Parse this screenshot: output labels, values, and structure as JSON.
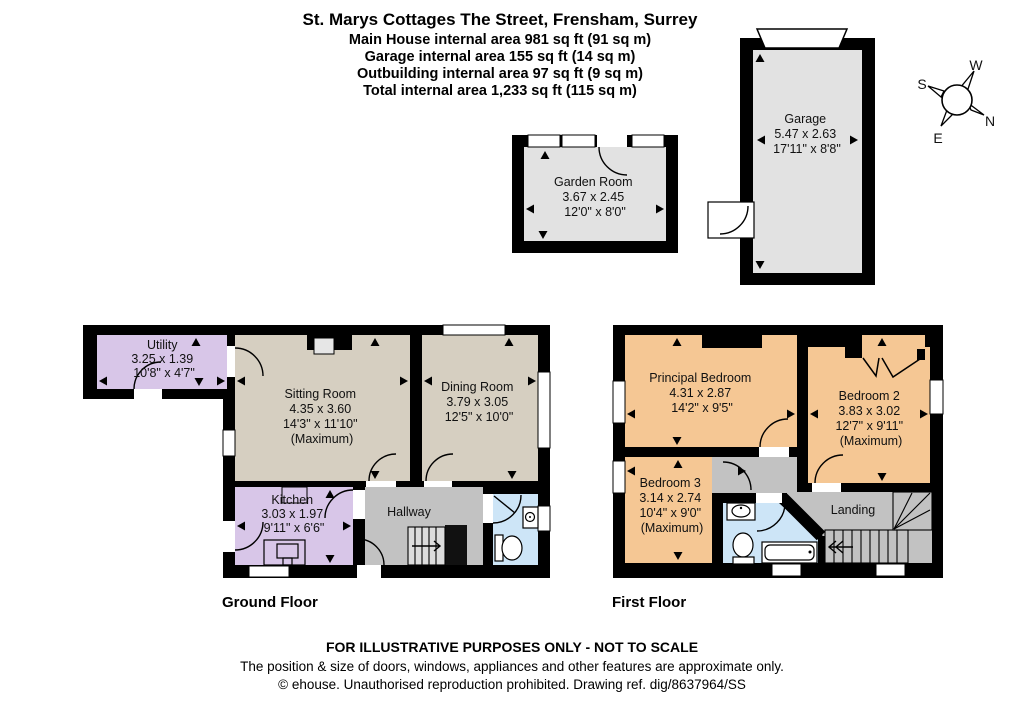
{
  "header": {
    "address": "St. Marys Cottages The Street, Frensham, Surrey",
    "area_lines": [
      "Main House internal area 981 sq ft (91 sq m)",
      "Garage internal area 155 sq ft (14 sq m)",
      "Outbuilding internal area 97 sq ft (9 sq m)",
      "Total internal area 1,233 sq ft (115 sq m)"
    ]
  },
  "compass": {
    "north": "N",
    "east": "E",
    "south": "S",
    "west": "W"
  },
  "rooms": {
    "garden_room": {
      "name": "Garden Room",
      "metric": "3.67 x 2.45",
      "imperial": "12'0\" x 8'0\""
    },
    "garage": {
      "name": "Garage",
      "metric": "5.47 x 2.63",
      "imperial": "17'11\" x 8'8\""
    },
    "utility": {
      "name": "Utility",
      "metric": "3.25 x 1.39",
      "imperial": "10'8\" x 4'7\""
    },
    "sitting_room": {
      "name": "Sitting Room",
      "metric": "4.35 x 3.60",
      "imperial": "14'3\" x 11'10\"",
      "qualifier": "(Maximum)"
    },
    "dining_room": {
      "name": "Dining Room",
      "metric": "3.79 x 3.05",
      "imperial": "12'5\" x 10'0\""
    },
    "kitchen": {
      "name": "Kitchen",
      "metric": "3.03 x 1.97",
      "imperial": "9'11\" x 6'6\""
    },
    "hallway": {
      "name": "Hallway"
    },
    "principal_bedroom": {
      "name": "Principal Bedroom",
      "metric": "4.31 x 2.87",
      "imperial": "14'2\" x 9'5\""
    },
    "bedroom_2": {
      "name": "Bedroom 2",
      "metric": "3.83 x 3.02",
      "imperial": "12'7\" x 9'11\"",
      "qualifier": "(Maximum)"
    },
    "bedroom_3": {
      "name": "Bedroom 3",
      "metric": "3.14 x 2.74",
      "imperial": "10'4\" x 9'0\"",
      "qualifier": "(Maximum)"
    },
    "landing": {
      "name": "Landing"
    }
  },
  "floor_labels": {
    "ground": "Ground Floor",
    "first": "First Floor"
  },
  "footer": {
    "line1": "FOR ILLUSTRATIVE PURPOSES ONLY - NOT TO SCALE",
    "line2": "The position & size of doors, windows, appliances and other features are approximate only.",
    "line3": "© ehouse. Unauthorised reproduction prohibited. Drawing ref. dig/8637964/SS"
  },
  "colors": {
    "wall": "#000000",
    "room_beige": "#d6cfc1",
    "room_purple": "#d8c6e8",
    "room_orange": "#f5c794",
    "room_grey": "#c2c2c2",
    "room_blue": "#cde5f7",
    "room_light_grey": "#e2e2e2"
  }
}
